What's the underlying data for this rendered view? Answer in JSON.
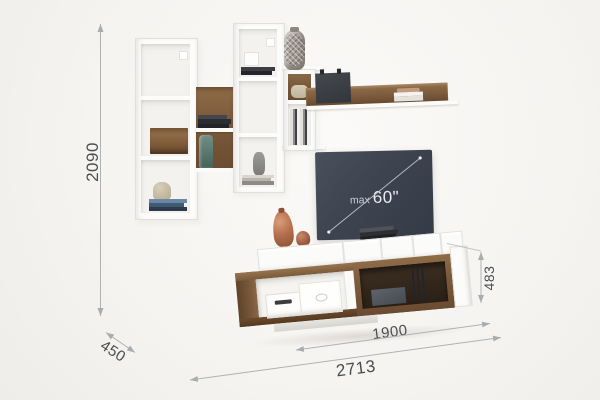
{
  "dimensions": {
    "total_height_mm": "2090",
    "depth_mm": "450",
    "total_width_mm": "2713",
    "cabinet_width_mm": "1900",
    "cabinet_height_mm": "483"
  },
  "tv": {
    "label_prefix": "max",
    "label_size": "60\""
  },
  "colors": {
    "background": "#f6f4f1",
    "white_furniture": "#fbfbfa",
    "wood": "#7b5a3c",
    "wood_interior_dark": "#33281e",
    "tv_screen": "#3d4450",
    "copper_vase": "#b5714f",
    "teal_bottle": "#5e7a72",
    "silver_vase": "#a49d96",
    "dimension_line": "#a8adb0",
    "dimension_text": "#4a4d4f"
  }
}
